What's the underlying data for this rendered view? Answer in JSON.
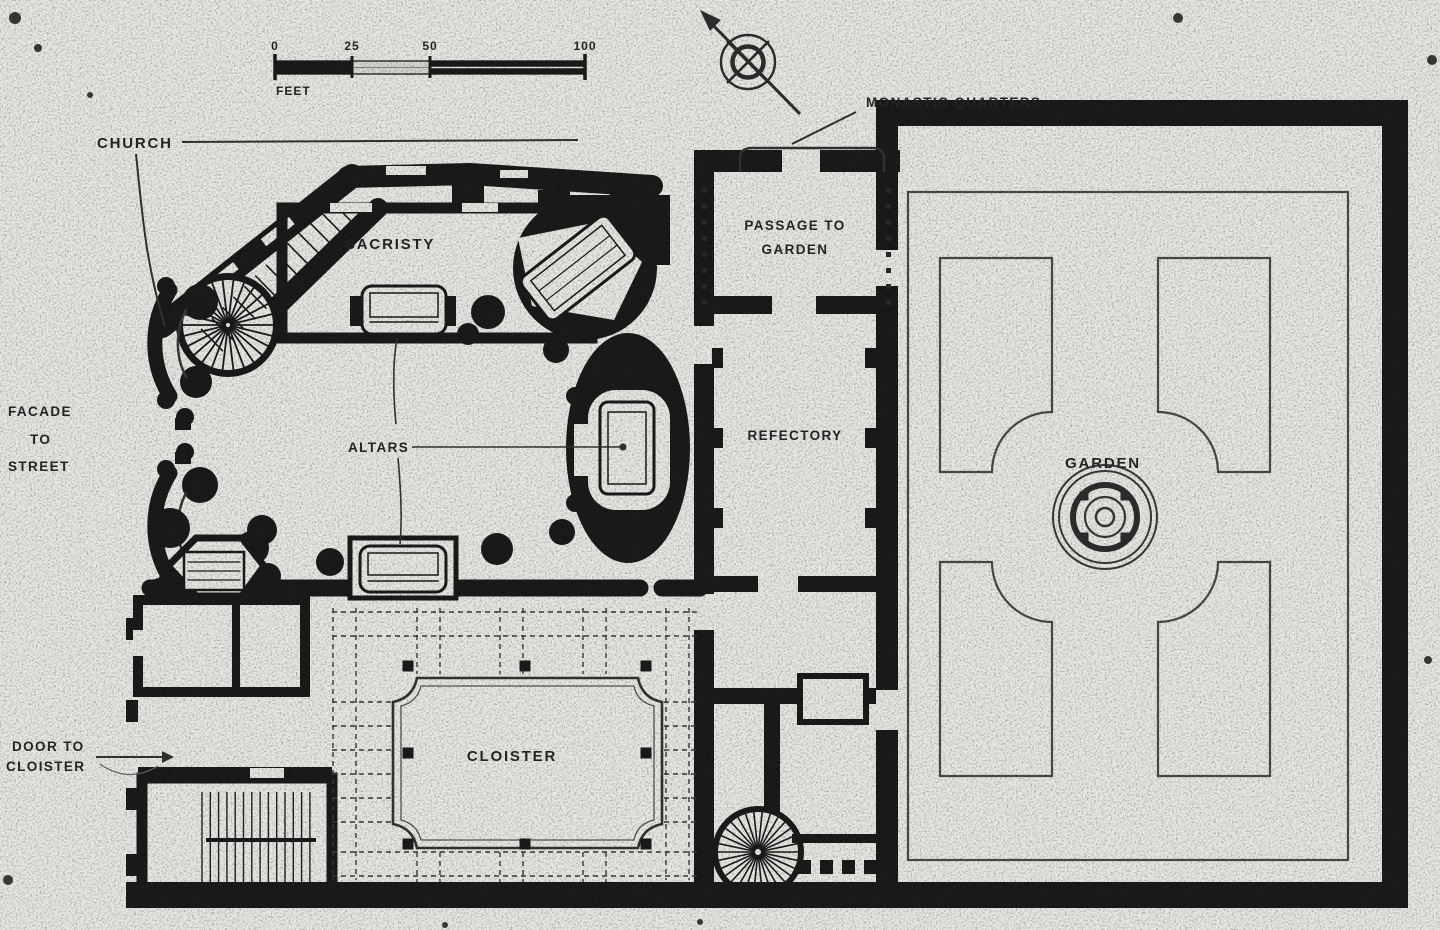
{
  "scale_bar": {
    "unit_label": "FEET",
    "ticks": [
      {
        "label": "0"
      },
      {
        "label": "25"
      },
      {
        "label": "50"
      },
      {
        "label": "100"
      }
    ]
  },
  "labels": {
    "church": "CHURCH",
    "monastic_quarters": "MONASTIC QUARTERS",
    "sacristy": "SACRISTY",
    "altars": "ALTARS",
    "facade_line1": "FACADE",
    "facade_line2": "TO",
    "facade_line3": "STREET",
    "passage_line1": "PASSAGE TO",
    "passage_line2": "GARDEN",
    "refectory": "REFECTORY",
    "garden": "GARDEN",
    "cloister": "CLOISTER",
    "door_line1": "DOOR TO",
    "door_line2": "CLOISTER"
  },
  "compass": {
    "name": "north-arrow"
  },
  "colors": {
    "paper": "#e9e7e3",
    "ink": "#1b1b1b",
    "line": "#4a4a4a",
    "text": "#262626"
  }
}
